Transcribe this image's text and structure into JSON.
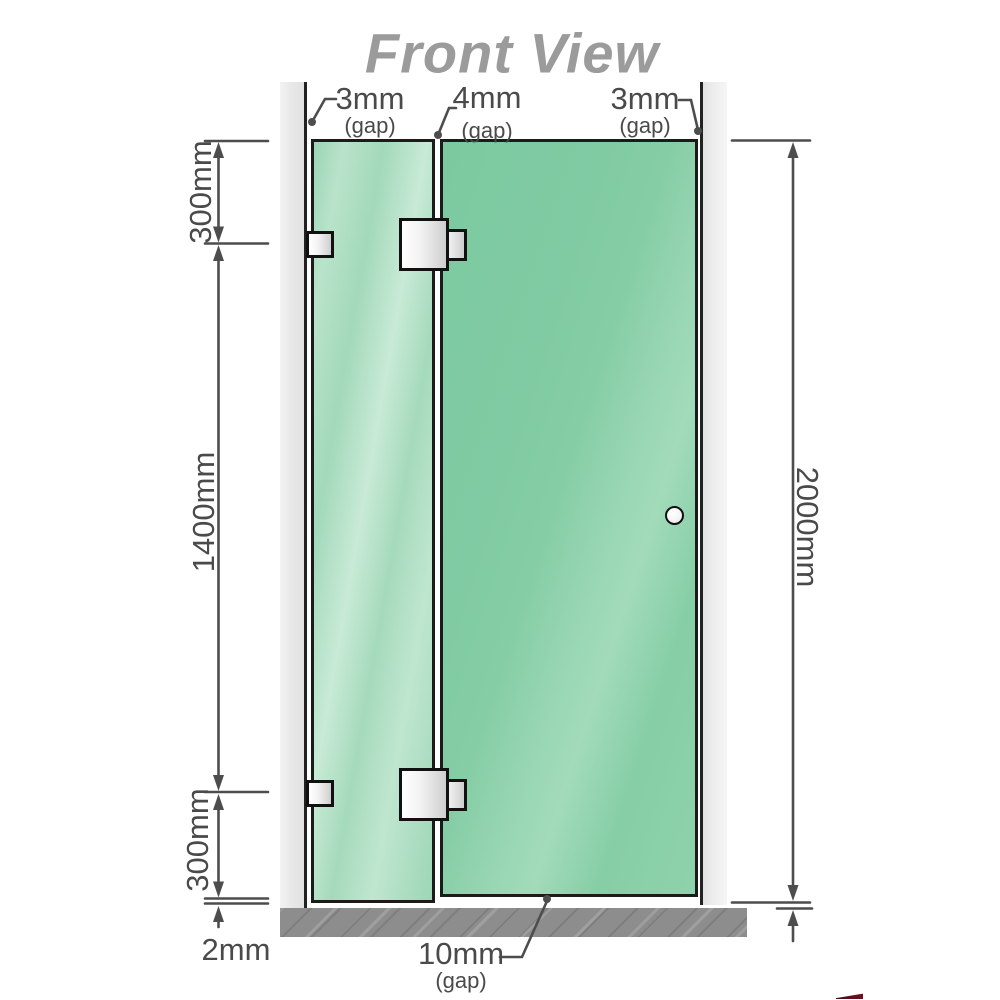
{
  "title": "Front View",
  "gaps": {
    "top_left": {
      "value": "3mm",
      "qualifier": "(gap)"
    },
    "top_middle": {
      "value": "4mm",
      "qualifier": "(gap)"
    },
    "top_right": {
      "value": "3mm",
      "qualifier": "(gap)"
    },
    "bottom": {
      "value": "10mm",
      "qualifier": "(gap)"
    }
  },
  "dims": {
    "left_top": "300mm",
    "left_middle": "1400mm",
    "left_bottom": "300mm",
    "floor_gap": "2mm",
    "right_full": "2000mm"
  },
  "colors": {
    "glass_door": "#7fcba3",
    "glass_panel": "#aadcbe",
    "glass_edge": "#1b1b1b",
    "wall": "#e9e9e9",
    "wall_edge": "#222222",
    "floor": "#8d8d8d",
    "line": "#4d4d4d",
    "label": "#4a4a4a",
    "title": "#9b9b9b",
    "hinge_metal": "#e6e6e6",
    "knob_fill": "#ffffff",
    "accent_red": "#6e1220"
  }
}
